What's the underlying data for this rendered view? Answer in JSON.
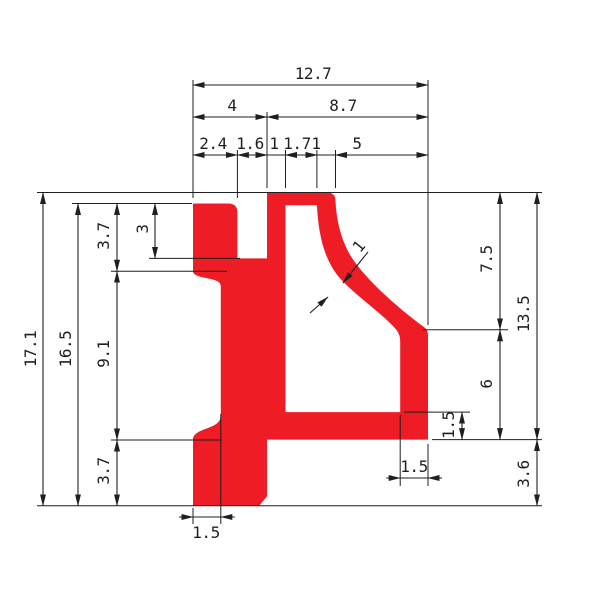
{
  "drawing": {
    "type": "technical-profile-cross-section",
    "colors": {
      "profile_fill": "#ee1c25",
      "line": "#1f1f1f",
      "background": "#ffffff",
      "tick_white": "#ffffff"
    }
  },
  "dimensions": {
    "horizontal": [
      {
        "label": "12.7",
        "x1": 193,
        "x2": 428,
        "y": 85,
        "tx": 313,
        "ty": 79,
        "arrows": "in"
      },
      {
        "label": "4",
        "x1": 193,
        "x2": 267,
        "y": 117,
        "tx": 232,
        "ty": 111,
        "arrows": "in"
      },
      {
        "label": "8.7",
        "x1": 267,
        "x2": 428,
        "y": 117,
        "tx": 343,
        "ty": 111,
        "arrows": "in"
      },
      {
        "label": "2.4",
        "x1": 193,
        "x2": 237.4,
        "y": 155,
        "tx": 213,
        "ty": 149,
        "arrows": "in"
      },
      {
        "label": "1.6",
        "x1": 237.4,
        "x2": 267,
        "y": 155,
        "tx": 250,
        "ty": 149,
        "arrows": "in"
      },
      {
        "label": "1",
        "x1": 267,
        "x2": 285.5,
        "y": 155,
        "tx": 274,
        "ty": 149,
        "arrows": "out"
      },
      {
        "label": "1.7",
        "x1": 285.5,
        "x2": 316.9,
        "y": 155,
        "tx": 297,
        "ty": 149,
        "arrows": "in"
      },
      {
        "label": "1",
        "x1": 316.9,
        "x2": 335.5,
        "y": 155,
        "tx": 316,
        "ty": 149,
        "arrows": "out"
      },
      {
        "label": "5",
        "x1": 335.5,
        "x2": 428,
        "y": 155,
        "tx": 357,
        "ty": 149,
        "arrows": "in"
      },
      {
        "label": "1.5",
        "x1": 193,
        "x2": 220.8,
        "y": 517,
        "tx": 206,
        "ty": 538,
        "arrows": "out"
      },
      {
        "label": "1.5",
        "x1": 400.2,
        "x2": 428,
        "y": 478,
        "tx": 414,
        "ty": 472,
        "arrows": "out"
      }
    ],
    "vertical": [
      {
        "label": "17.1",
        "y1": 192.5,
        "y2": 505.8,
        "x": 43,
        "tx": 36,
        "ty": 349
      },
      {
        "label": "16.5",
        "y1": 203.5,
        "y2": 505.8,
        "x": 78,
        "tx": 71,
        "ty": 349
      },
      {
        "label": "3.7",
        "y1": 203.5,
        "y2": 271.2,
        "x": 117,
        "tx": 109,
        "ty": 236
      },
      {
        "label": "9.1",
        "y1": 271.2,
        "y2": 440,
        "x": 117,
        "tx": 109,
        "ty": 354
      },
      {
        "label": "3.7",
        "y1": 440,
        "y2": 505.8,
        "x": 117,
        "tx": 109,
        "ty": 471
      },
      {
        "label": "3",
        "y1": 203.5,
        "y2": 258.4,
        "x": 155,
        "tx": 148,
        "ty": 229
      },
      {
        "label": "7.5",
        "y1": 192.5,
        "y2": 329.8,
        "x": 500,
        "tx": 492,
        "ty": 259
      },
      {
        "label": "6",
        "y1": 329.8,
        "y2": 439.6,
        "x": 500,
        "tx": 492,
        "ty": 384
      },
      {
        "label": "13.5",
        "y1": 192.5,
        "y2": 439.6,
        "x": 537,
        "tx": 529,
        "ty": 314
      },
      {
        "label": "3.6",
        "y1": 439.6,
        "y2": 505.8,
        "x": 537,
        "tx": 529,
        "ty": 474
      },
      {
        "label": "1.5",
        "y1": 412.1,
        "y2": 439.6,
        "x": 462,
        "tx": 454,
        "ty": 425
      }
    ],
    "leader": {
      "label": "1",
      "tx": 363,
      "ty": 250,
      "angle": -50,
      "lines": [
        [
          368,
          252,
          343,
          283
        ],
        [
          310,
          313,
          328,
          297
        ]
      ],
      "ticks": [
        [
          326,
          301,
          343,
          287
        ],
        [
          321,
          296,
          338,
          282
        ]
      ]
    },
    "extension_lines": [
      [
        193,
        198,
        193,
        80
      ],
      [
        237.4,
        198,
        237.4,
        150
      ],
      [
        267,
        188,
        267,
        112
      ],
      [
        285.5,
        188,
        285.5,
        150
      ],
      [
        316.9,
        188,
        316.9,
        150
      ],
      [
        335.5,
        188,
        335.5,
        150
      ],
      [
        428,
        325,
        428,
        80
      ],
      [
        37,
        192.5,
        542,
        192.5
      ],
      [
        72,
        203.5,
        192,
        203.5
      ],
      [
        149,
        258.4,
        240,
        258.4
      ],
      [
        111,
        271.2,
        227,
        271.2
      ],
      [
        111,
        440,
        222,
        440
      ],
      [
        37,
        505.8,
        542,
        505.8
      ],
      [
        423,
        329.8,
        508,
        329.8
      ],
      [
        404,
        412.1,
        470,
        412.1
      ],
      [
        432,
        439.6,
        542,
        439.6
      ],
      [
        193,
        508,
        193,
        524
      ],
      [
        220.8,
        414,
        220.8,
        524
      ],
      [
        400.2,
        415,
        400.2,
        486
      ],
      [
        428,
        444,
        428,
        486
      ]
    ]
  }
}
